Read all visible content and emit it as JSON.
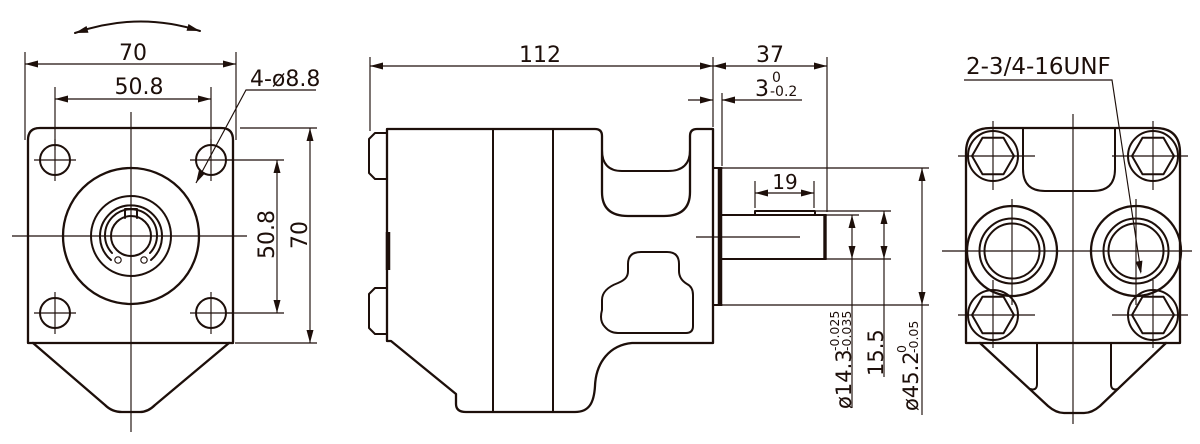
{
  "drawing": {
    "type": "engineering-drawing-3-view",
    "subject": "hydraulic gear pump",
    "line_color": "#1d0f0a",
    "background_color": "#ffffff",
    "front_view": {
      "dim_width": "70",
      "dim_bolt_spacing_horizontal": "50.8",
      "dim_bolt_holes": "4-ø8.8",
      "dim_bolt_spacing_vertical": "50.8",
      "dim_height": "70"
    },
    "side_view": {
      "dim_body_length": "112",
      "dim_shaft_extension": "37",
      "dim_pilot_depth_value": "3",
      "dim_pilot_depth_tol_upper": "0",
      "dim_pilot_depth_tol_lower": "-0.2",
      "dim_key_length": "19",
      "dim_shaft_diameter_value": "ø14.3",
      "dim_shaft_diameter_tol_upper": "-0.025",
      "dim_shaft_diameter_tol_lower": "-0.035",
      "dim_over_key_height": "15.5",
      "dim_pilot_diameter_value": "ø45.2",
      "dim_pilot_diameter_tol_upper": "0",
      "dim_pilot_diameter_tol_lower": "-0.05"
    },
    "rear_view": {
      "label_port_thread": "2-3/4-16UNF"
    }
  }
}
